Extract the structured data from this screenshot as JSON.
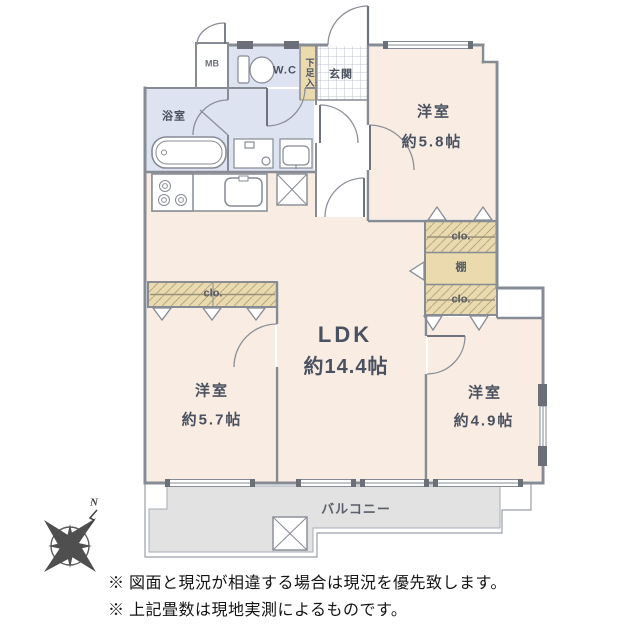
{
  "floorplan": {
    "labels": {
      "mb": "MB",
      "wc": "W.C",
      "shoe_box": "下足入",
      "entrance": "玄関",
      "bath": "浴室",
      "washroom": "洗面室",
      "bedroom_tr_name": "洋室",
      "bedroom_tr_size": "約5.8帖",
      "closet_top": "clo.",
      "shelf": "棚",
      "closet_mid": "clo.",
      "closet_left": "clo.",
      "ldk_name": "LDK",
      "ldk_size": "約14.4帖",
      "bedroom_bl_name": "洋室",
      "bedroom_bl_size": "約5.7帖",
      "bedroom_br_name": "洋室",
      "bedroom_br_size": "約4.9帖",
      "balcony": "バルコニー",
      "compass_n": "N"
    },
    "notes": [
      "※ 図面と現況が相違する場合は現況を優先致します。",
      "※ 上記畳数は現地実測によるものです。"
    ],
    "colors": {
      "room_fill": "#f9ede3",
      "wet_room_fill": "#dde3f0",
      "closet_fill": "#eadaae",
      "balcony_fill": "#e2e2e2",
      "wall": "#868b94",
      "label_text": "#4a5160",
      "note_text": "#141414"
    }
  }
}
